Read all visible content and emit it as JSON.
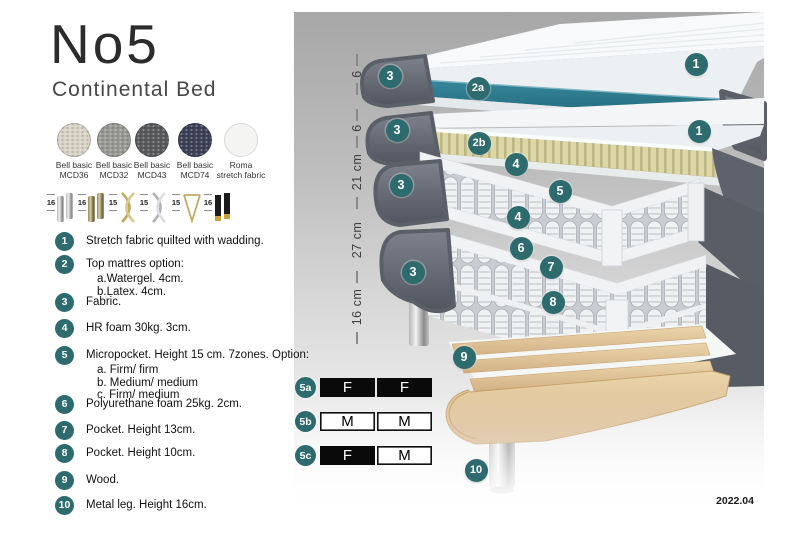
{
  "header": {
    "title": "No5",
    "subtitle": "Continental Bed"
  },
  "fabric_swatches": [
    {
      "line1": "Bell basic",
      "line2": "MCD36",
      "color": "#d8d3c5"
    },
    {
      "line1": "Bell basic",
      "line2": "MCD32",
      "color": "#999a96"
    },
    {
      "line1": "Bell basic",
      "line2": "MCD43",
      "color": "#595b5d"
    },
    {
      "line1": "Bell basic",
      "line2": "MCD74",
      "color": "#3e4257"
    },
    {
      "line1": "Roma",
      "line2": "stretch fabric",
      "color": "#f4f4f2"
    }
  ],
  "leg_options": [
    {
      "height": "16",
      "kind": "chrome cylinder"
    },
    {
      "height": "16",
      "kind": "brass cylinder"
    },
    {
      "height": "15",
      "kind": "gold twisted"
    },
    {
      "height": "15",
      "kind": "silver twisted"
    },
    {
      "height": "15",
      "kind": "hairpin"
    },
    {
      "height": "16",
      "kind": "black with gold tip"
    }
  ],
  "legend": [
    {
      "num": "1",
      "text": "Stretch fabric quilted with wadding."
    },
    {
      "num": "2",
      "text": "Top mattres option:",
      "sub": [
        "a.Watergel. 4cm.",
        "b.Latex. 4cm."
      ]
    },
    {
      "num": "3",
      "text": "Fabric."
    },
    {
      "num": "4",
      "text": "HR foam 30kg. 3cm."
    },
    {
      "num": "5",
      "text": "Micropocket. Height 15 cm. 7zones. Option:",
      "sub": [
        "a. Firm/ firm",
        "b. Medium/ medium",
        "c. Firm/ medium"
      ]
    },
    {
      "num": "6",
      "text": "Polyurethane foam 25kg. 2cm."
    },
    {
      "num": "7",
      "text": "Pocket. Height 13cm."
    },
    {
      "num": "8",
      "text": "Pocket. Height 10cm."
    },
    {
      "num": "9",
      "text": "Wood."
    },
    {
      "num": "10",
      "text": "Metal leg. Height 16cm."
    }
  ],
  "diagram": {
    "badges": [
      {
        "label": "1"
      },
      {
        "label": "3"
      },
      {
        "label": "2a"
      },
      {
        "label": "1"
      },
      {
        "label": "3"
      },
      {
        "label": "2b"
      },
      {
        "label": "4"
      },
      {
        "label": "3"
      },
      {
        "label": "5"
      },
      {
        "label": "4"
      },
      {
        "label": "6"
      },
      {
        "label": "7"
      },
      {
        "label": "3"
      },
      {
        "label": "8"
      },
      {
        "label": "9"
      },
      {
        "label": "10"
      }
    ],
    "dimensions": [
      {
        "label": "6"
      },
      {
        "label": "6"
      },
      {
        "label": "21 cm"
      },
      {
        "label": "27 cm"
      },
      {
        "label": "16 cm"
      }
    ],
    "firmness_options": [
      {
        "badge": "5a",
        "cells": [
          {
            "letter": "F",
            "variant": "dark"
          },
          {
            "letter": "F",
            "variant": "dark"
          }
        ]
      },
      {
        "badge": "5b",
        "cells": [
          {
            "letter": "M",
            "variant": "light"
          },
          {
            "letter": "M",
            "variant": "light"
          }
        ]
      },
      {
        "badge": "5c",
        "cells": [
          {
            "letter": "F",
            "variant": "dark"
          },
          {
            "letter": "M",
            "variant": "light"
          }
        ]
      }
    ],
    "version": "2022.04",
    "colors": {
      "badge_teal": "#2d6b6f",
      "topper_teal": "#2e7d92",
      "latex_yellow": "#ddd7a6",
      "fabric_gray": "#62676f",
      "wood": "#e7cfa4"
    }
  }
}
